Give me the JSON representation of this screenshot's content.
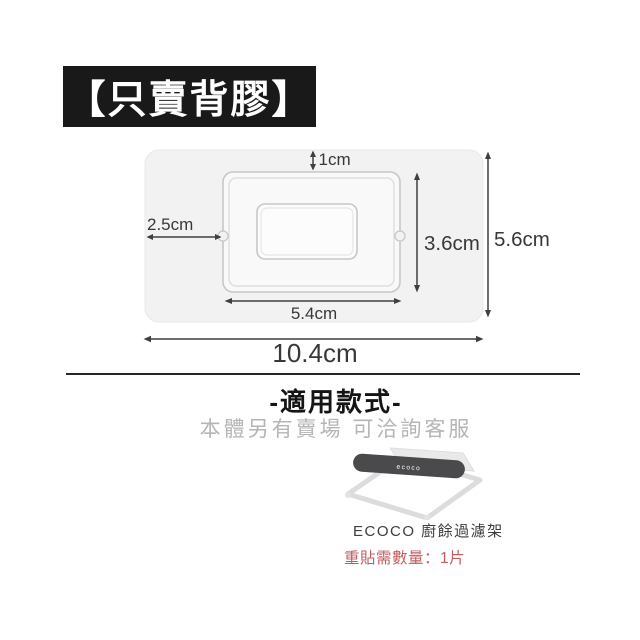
{
  "badge": {
    "label": "【只賣背膠】",
    "background": "#191919",
    "text_color": "#ffffff"
  },
  "diagram": {
    "annotation_color": "#3f3f3f",
    "sheet_color": "#f2f2f3",
    "dimensions": {
      "top_gap": "1cm",
      "left_edge_to_base": "2.5cm",
      "base_height": "3.6cm",
      "sheet_height": "5.6cm",
      "base_width": "5.4cm",
      "sheet_width": "10.4cm"
    }
  },
  "applicable_section": {
    "title": "-適用款式-",
    "subtitle": "本體另有賣場 可洽詢客服",
    "subtitle_color": "#b5b5b5",
    "product": {
      "bar_brand": "ecoco",
      "caption": "ECOCO 廚餘過濾架",
      "quantity_note": "重貼需數量：1片",
      "quantity_note_color": "#c25e61"
    }
  }
}
